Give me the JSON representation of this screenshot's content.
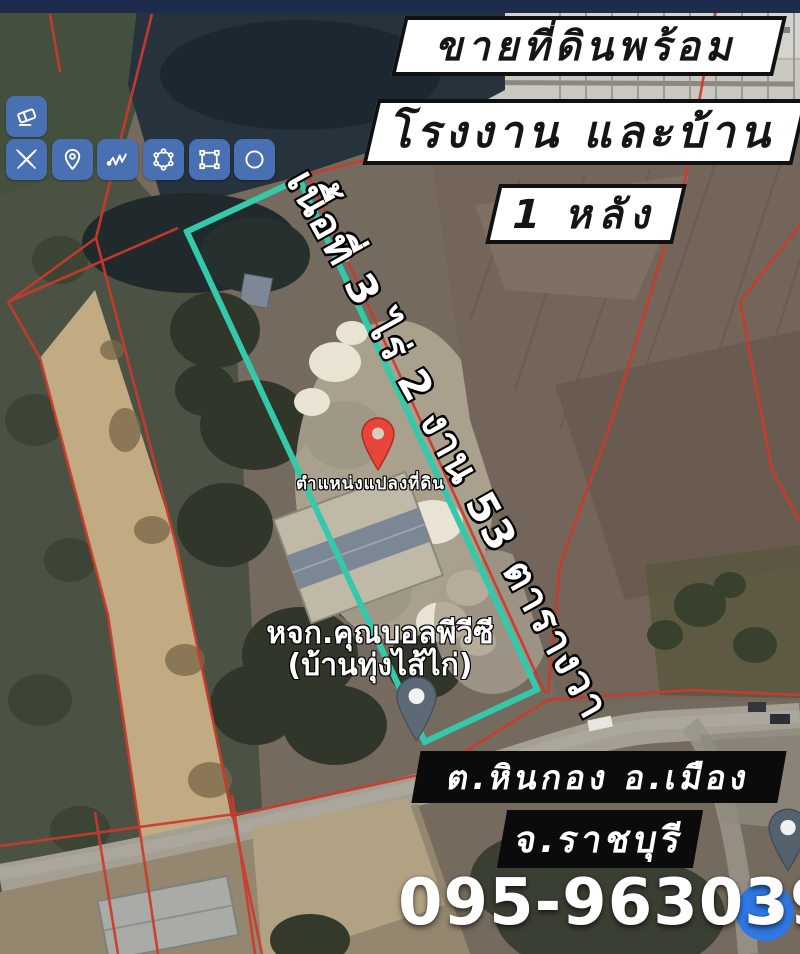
{
  "colors": {
    "top_bar": "#1d2b4c",
    "toolbar_blue": "#4a70b4",
    "highlight_teal": "#35c9ab",
    "boundary_red": "#cc3a2b",
    "pin_red": "#e8443a",
    "poi_pin_grey": "#5c6a77",
    "location_dot_blue": "#2f78e3",
    "banner_bg": "#ffffff",
    "banner_text": "#151515",
    "footer_box_bg": "#0b0b0b",
    "footer_text": "#ffffff"
  },
  "toolbar": {
    "tools": [
      {
        "label": "eraser"
      },
      {
        "label": "draw"
      },
      {
        "label": "pin"
      },
      {
        "label": "polyline"
      },
      {
        "label": "polygon"
      },
      {
        "label": "rectangle"
      },
      {
        "label": "circle"
      }
    ]
  },
  "banners": {
    "line1": "ขายที่ดินพร้อม",
    "line2": "โรงงาน และบ้าน",
    "line3": "1 หลัง"
  },
  "area_label": "เนื้อที่ 3 ไร่ 2 งาน 53 ตารางวา",
  "map_labels": {
    "plot_position": "ตำแหน่งแปลงที่ดิน",
    "business_name": "หจก.คุณบอลพีวีซี",
    "business_name2": "(บ้านทุ่งไส้ไก่)"
  },
  "footer": {
    "district": "ต.หินกอง อ.เมือง",
    "province": "จ.ราชบุรี",
    "phone": "095-9630395"
  }
}
